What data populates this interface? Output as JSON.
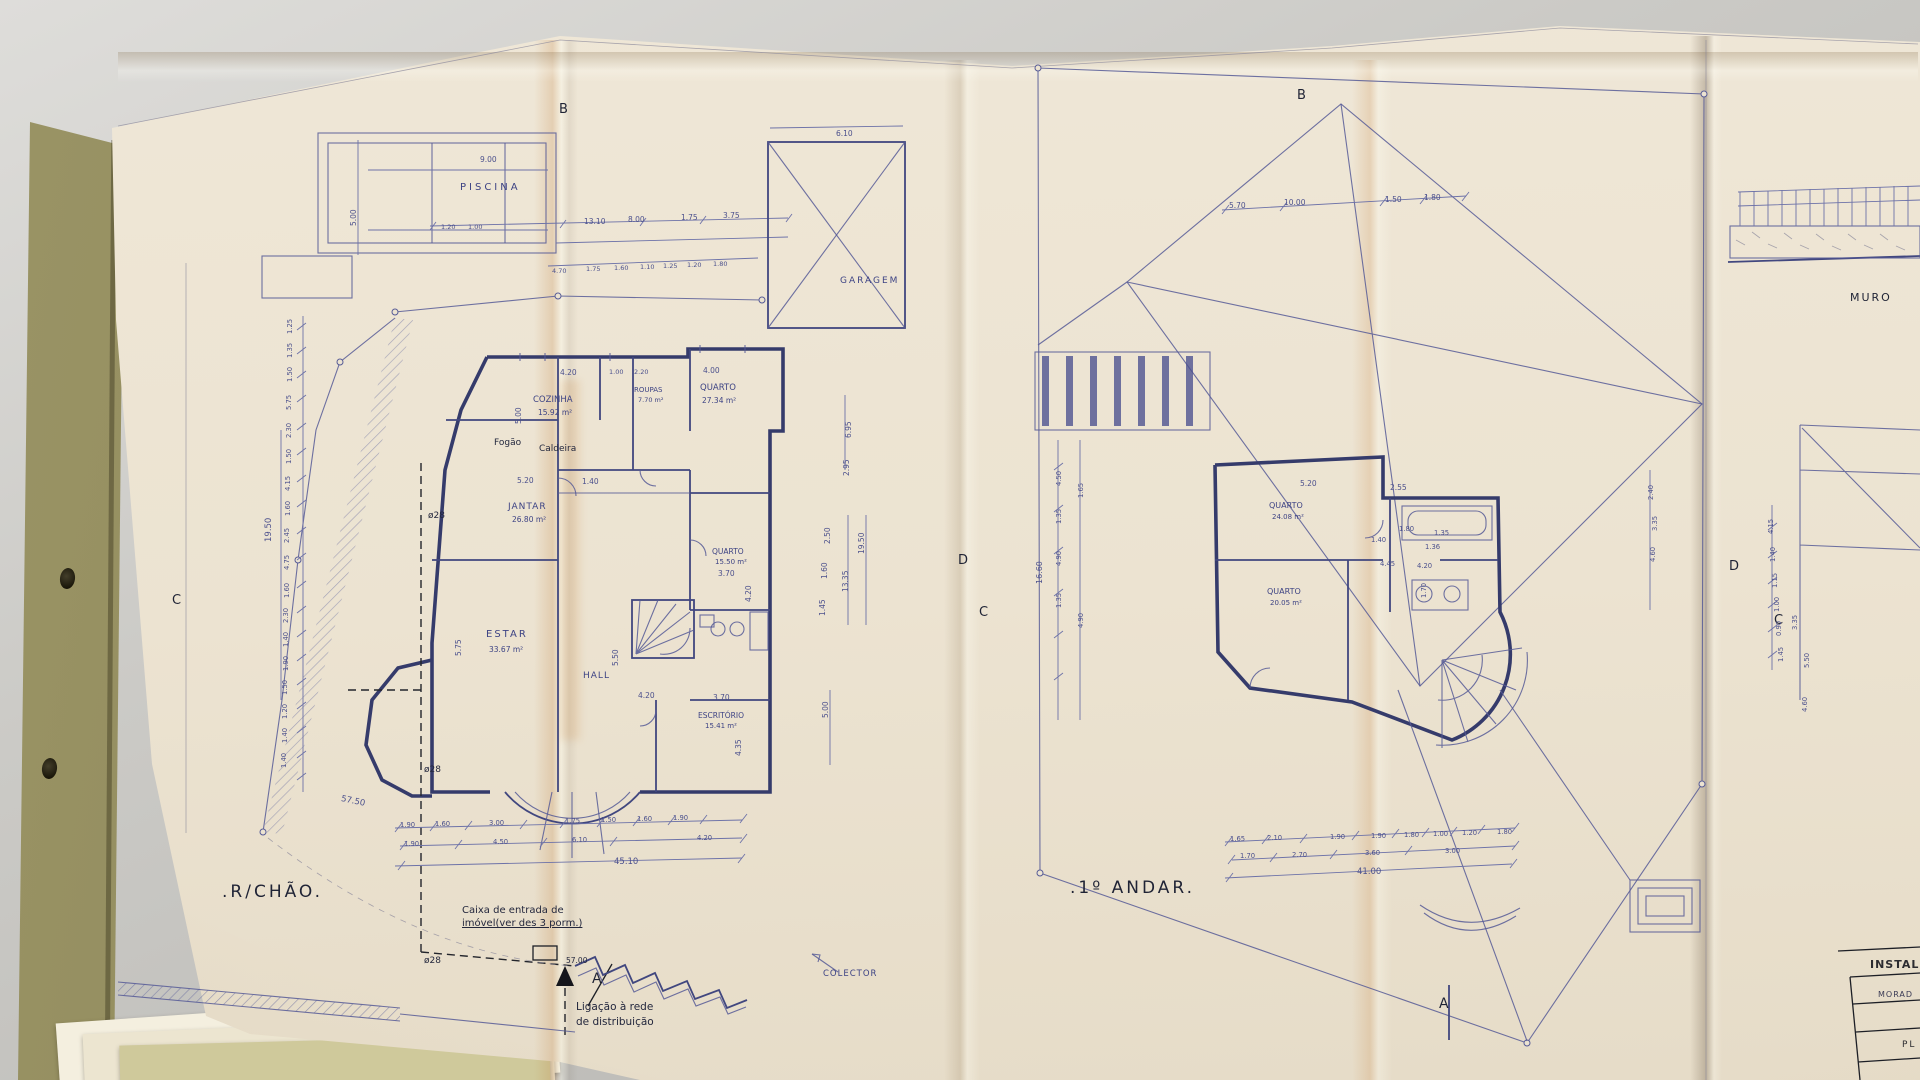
{
  "title_block": {
    "header": "INSTAL",
    "row1": "MORAD",
    "row2": "PL"
  },
  "plans": {
    "ground_floor_label": ".R/CHÃO.",
    "first_floor_label": ".1º ANDAR."
  },
  "colors": {
    "ink": "#3d4384",
    "wall": "#353b6b",
    "paper": "#ece3d1",
    "desk": "#c9c8c4",
    "note_ink": "#23273d",
    "stain": "#c67a34"
  },
  "annotations": [
    {
      "n": "room-label-piscina",
      "t": "PISCINA",
      "x": 460,
      "y": 183,
      "s": 10,
      "k": "ink",
      "ls": 3
    },
    {
      "t": "9.00",
      "x": 480,
      "y": 156,
      "k": "dim"
    },
    {
      "t": "5.00",
      "x": 350,
      "y": 226,
      "r": -90,
      "k": "dim"
    },
    {
      "t": "1.20",
      "x": 441,
      "y": 224,
      "s": 6.5,
      "k": "dim"
    },
    {
      "t": "1.00",
      "x": 468,
      "y": 224,
      "s": 6.5,
      "k": "dim"
    },
    {
      "t": "13.10",
      "x": 584,
      "y": 218,
      "k": "dim"
    },
    {
      "t": "8.00",
      "x": 628,
      "y": 216,
      "k": "dim"
    },
    {
      "t": "1.75",
      "x": 681,
      "y": 214,
      "k": "dim"
    },
    {
      "t": "3.75",
      "x": 723,
      "y": 212,
      "k": "dim"
    },
    {
      "t": "4.70",
      "x": 552,
      "y": 268,
      "s": 6.5,
      "k": "dim"
    },
    {
      "t": "1.75",
      "x": 586,
      "y": 266,
      "s": 6.5,
      "k": "dim"
    },
    {
      "t": "1.60",
      "x": 614,
      "y": 265,
      "s": 6.5,
      "k": "dim"
    },
    {
      "t": "1.10",
      "x": 640,
      "y": 264,
      "s": 6.5,
      "k": "dim"
    },
    {
      "t": "1.25",
      "x": 663,
      "y": 263,
      "s": 6.5,
      "k": "dim"
    },
    {
      "t": "1.20",
      "x": 687,
      "y": 262,
      "s": 6.5,
      "k": "dim"
    },
    {
      "t": "1.80",
      "x": 713,
      "y": 261,
      "s": 6.5,
      "k": "dim"
    },
    {
      "t": "6.10",
      "x": 836,
      "y": 130,
      "k": "dim"
    },
    {
      "n": "room-label-garagem",
      "t": "GARAGEM",
      "x": 840,
      "y": 277,
      "s": 9,
      "k": "ink",
      "ls": 2
    },
    {
      "n": "section-marker-b-left",
      "t": "B",
      "x": 559,
      "y": 103,
      "s": 13,
      "k": "big"
    },
    {
      "n": "room-label-cozinha",
      "t": "COZINHA",
      "x": 533,
      "y": 396,
      "s": 8.5,
      "k": "ink"
    },
    {
      "t": "15.92 m²",
      "x": 538,
      "y": 409,
      "s": 7.5,
      "k": "ink"
    },
    {
      "t": "4.20",
      "x": 560,
      "y": 369,
      "k": "dim"
    },
    {
      "t": "1.00",
      "x": 609,
      "y": 369,
      "s": 6.5,
      "k": "dim"
    },
    {
      "t": "2.20",
      "x": 634,
      "y": 369,
      "s": 6.5,
      "k": "dim"
    },
    {
      "t": "4.00",
      "x": 703,
      "y": 367,
      "k": "dim"
    },
    {
      "n": "room-label-roupas",
      "t": "ROUPAS",
      "x": 634,
      "y": 387,
      "s": 7,
      "k": "ink"
    },
    {
      "t": "7.70 m²",
      "x": 638,
      "y": 397,
      "s": 6.5,
      "k": "ink"
    },
    {
      "n": "room-label-quarto-1",
      "t": "QUARTO",
      "x": 700,
      "y": 384,
      "s": 8.5,
      "k": "ink"
    },
    {
      "t": "27.34 m²",
      "x": 702,
      "y": 397,
      "s": 7.5,
      "k": "ink"
    },
    {
      "n": "note-fogao",
      "t": "Fogão",
      "x": 494,
      "y": 439,
      "s": 9,
      "k": "note"
    },
    {
      "n": "note-caldeira",
      "t": "Caldeira",
      "x": 539,
      "y": 445,
      "s": 9,
      "k": "note"
    },
    {
      "t": "5.00",
      "x": 515,
      "y": 424,
      "r": -90,
      "k": "dim"
    },
    {
      "t": "5.20",
      "x": 517,
      "y": 477,
      "k": "dim"
    },
    {
      "t": "1.40",
      "x": 582,
      "y": 478,
      "k": "dim"
    },
    {
      "n": "note-diameter-1",
      "t": "ø28",
      "x": 428,
      "y": 512,
      "s": 9,
      "k": "note"
    },
    {
      "n": "room-label-jantar",
      "t": "JANTAR",
      "x": 508,
      "y": 503,
      "s": 9,
      "k": "ink",
      "ls": 1
    },
    {
      "t": "26.80 m²",
      "x": 512,
      "y": 516,
      "s": 7.5,
      "k": "ink"
    },
    {
      "n": "room-label-estar",
      "t": "ESTAR",
      "x": 486,
      "y": 630,
      "s": 10,
      "k": "ink",
      "ls": 2
    },
    {
      "t": "33.67 m²",
      "x": 489,
      "y": 646,
      "s": 7.5,
      "k": "ink"
    },
    {
      "t": "5.75",
      "x": 455,
      "y": 656,
      "r": -90,
      "k": "dim"
    },
    {
      "n": "room-label-hall",
      "t": "HALL",
      "x": 583,
      "y": 672,
      "s": 9,
      "k": "ink",
      "ls": 1
    },
    {
      "t": "5.50",
      "x": 612,
      "y": 666,
      "r": -90,
      "k": "dim"
    },
    {
      "t": "4.20",
      "x": 638,
      "y": 692,
      "k": "dim"
    },
    {
      "n": "room-label-quarto-2",
      "t": "QUARTO",
      "x": 712,
      "y": 548,
      "s": 7.5,
      "k": "ink"
    },
    {
      "t": "15.50 m²",
      "x": 715,
      "y": 559,
      "s": 7,
      "k": "ink"
    },
    {
      "t": "3.70",
      "x": 718,
      "y": 570,
      "k": "dim"
    },
    {
      "t": "4.20",
      "x": 745,
      "y": 602,
      "r": -90,
      "k": "dim"
    },
    {
      "n": "room-label-escritorio",
      "t": "ESCRITÓRIO",
      "x": 698,
      "y": 712,
      "s": 7.5,
      "k": "ink"
    },
    {
      "t": "15.41 m²",
      "x": 705,
      "y": 723,
      "s": 7,
      "k": "ink"
    },
    {
      "t": "3.70",
      "x": 713,
      "y": 694,
      "k": "dim"
    },
    {
      "t": "4.35",
      "x": 735,
      "y": 756,
      "r": -90,
      "k": "dim"
    },
    {
      "t": "5.00",
      "x": 822,
      "y": 718,
      "r": -90,
      "k": "dim"
    },
    {
      "t": "2.50",
      "x": 824,
      "y": 544,
      "r": -90,
      "k": "dim"
    },
    {
      "t": "1.60",
      "x": 821,
      "y": 579,
      "r": -90,
      "k": "dim"
    },
    {
      "t": "1.45",
      "x": 819,
      "y": 616,
      "r": -90,
      "k": "dim"
    },
    {
      "t": "13.35",
      "x": 842,
      "y": 592,
      "r": -90,
      "k": "dim"
    },
    {
      "t": "19.50",
      "x": 858,
      "y": 554,
      "r": -90,
      "k": "dim"
    },
    {
      "t": "6.95",
      "x": 845,
      "y": 438,
      "r": -90,
      "k": "dim"
    },
    {
      "t": "2.95",
      "x": 843,
      "y": 476,
      "r": -90,
      "k": "dim"
    },
    {
      "t": "19.50",
      "x": 265,
      "y": 542,
      "r": -90,
      "k": "dim",
      "s": 8.5
    },
    {
      "t": "1.25",
      "x": 287,
      "y": 334,
      "r": -90,
      "k": "dim",
      "s": 6.8
    },
    {
      "t": "1.35",
      "x": 287,
      "y": 358,
      "r": -90,
      "k": "dim",
      "s": 6.8
    },
    {
      "t": "1.50",
      "x": 287,
      "y": 382,
      "r": -90,
      "k": "dim",
      "s": 6.8
    },
    {
      "t": "5.75",
      "x": 286,
      "y": 410,
      "r": -90,
      "k": "dim",
      "s": 6.8
    },
    {
      "t": "2.30",
      "x": 286,
      "y": 438,
      "r": -90,
      "k": "dim",
      "s": 6.8
    },
    {
      "t": "1.50",
      "x": 286,
      "y": 464,
      "r": -90,
      "k": "dim",
      "s": 6.8
    },
    {
      "t": "4.15",
      "x": 285,
      "y": 491,
      "r": -90,
      "k": "dim",
      "s": 6.8
    },
    {
      "t": "1.60",
      "x": 285,
      "y": 516,
      "r": -90,
      "k": "dim",
      "s": 6.8
    },
    {
      "t": "2.45",
      "x": 284,
      "y": 543,
      "r": -90,
      "k": "dim",
      "s": 6.8
    },
    {
      "t": "4.75",
      "x": 284,
      "y": 570,
      "r": -90,
      "k": "dim",
      "s": 6.8
    },
    {
      "t": "1.60",
      "x": 284,
      "y": 598,
      "r": -90,
      "k": "dim",
      "s": 6.8
    },
    {
      "t": "2.30",
      "x": 283,
      "y": 623,
      "r": -90,
      "k": "dim",
      "s": 6.8
    },
    {
      "t": "1.40",
      "x": 283,
      "y": 647,
      "r": -90,
      "k": "dim",
      "s": 6.8
    },
    {
      "t": "1.90",
      "x": 283,
      "y": 671,
      "r": -90,
      "k": "dim",
      "s": 6.8
    },
    {
      "t": "1.50",
      "x": 282,
      "y": 695,
      "r": -90,
      "k": "dim",
      "s": 6.8
    },
    {
      "t": "1.20",
      "x": 282,
      "y": 719,
      "r": -90,
      "k": "dim",
      "s": 6.8
    },
    {
      "t": "1.40",
      "x": 282,
      "y": 743,
      "r": -90,
      "k": "dim",
      "s": 6.8
    },
    {
      "t": "1.40",
      "x": 281,
      "y": 768,
      "r": -90,
      "k": "dim",
      "s": 6.8
    },
    {
      "t": "57.50",
      "x": 342,
      "y": 795,
      "r": 12,
      "k": "dim",
      "s": 8.5
    },
    {
      "t": "1.90",
      "x": 400,
      "y": 822,
      "s": 6.8,
      "k": "dim"
    },
    {
      "t": "1.60",
      "x": 435,
      "y": 821,
      "s": 6.8,
      "k": "dim"
    },
    {
      "t": "3.00",
      "x": 489,
      "y": 820,
      "s": 6.8,
      "k": "dim"
    },
    {
      "t": "1.75",
      "x": 565,
      "y": 818,
      "s": 6.8,
      "k": "dim"
    },
    {
      "t": "1.50",
      "x": 601,
      "y": 817,
      "s": 6.8,
      "k": "dim"
    },
    {
      "t": "1.60",
      "x": 637,
      "y": 816,
      "s": 6.8,
      "k": "dim"
    },
    {
      "t": "1.90",
      "x": 673,
      "y": 815,
      "s": 6.8,
      "k": "dim"
    },
    {
      "t": "1.90",
      "x": 404,
      "y": 841,
      "s": 6.8,
      "k": "dim"
    },
    {
      "t": "4.50",
      "x": 493,
      "y": 839,
      "s": 6.8,
      "k": "dim"
    },
    {
      "t": "6.10",
      "x": 572,
      "y": 837,
      "s": 6.8,
      "k": "dim"
    },
    {
      "t": "4.20",
      "x": 697,
      "y": 835,
      "s": 6.8,
      "k": "dim"
    },
    {
      "t": "45.10",
      "x": 614,
      "y": 858,
      "s": 8.5,
      "k": "dim"
    },
    {
      "n": "note-diameter-2",
      "t": "ø28",
      "x": 424,
      "y": 766,
      "s": 9,
      "k": "note"
    },
    {
      "n": "note-diameter-3",
      "t": "ø28",
      "x": 424,
      "y": 957,
      "s": 9,
      "k": "note"
    },
    {
      "n": "floor-label-ground",
      "t": ".R/CHÃO.",
      "x": 222,
      "y": 884,
      "s": 17,
      "k": "big"
    },
    {
      "n": "note-caixa-line1",
      "t": "Caixa de entrada de",
      "x": 462,
      "y": 906,
      "s": 10,
      "k": "note"
    },
    {
      "n": "note-caixa-line2",
      "t": "imóvel(ver des 3 porm.)",
      "x": 462,
      "y": 919,
      "s": 10,
      "k": "note",
      "u": 1
    },
    {
      "t": "57.00",
      "x": 566,
      "y": 957,
      "s": 7.5,
      "k": "note"
    },
    {
      "n": "section-marker-a-left",
      "t": "A",
      "x": 592,
      "y": 972,
      "s": 14,
      "k": "big"
    },
    {
      "n": "note-ligacao-line1",
      "t": "Ligação à rede",
      "x": 576,
      "y": 1002,
      "s": 10.5,
      "k": "note"
    },
    {
      "n": "note-ligacao-line2",
      "t": "de distribuição",
      "x": 576,
      "y": 1017,
      "s": 10.5,
      "k": "note"
    },
    {
      "n": "label-colector",
      "t": "COLECTOR",
      "x": 823,
      "y": 970,
      "s": 8.5,
      "k": "ink",
      "ls": 1
    },
    {
      "n": "section-marker-c-left",
      "t": "C",
      "x": 172,
      "y": 594,
      "s": 13,
      "k": "big"
    },
    {
      "n": "section-marker-d-left",
      "t": "D",
      "x": 958,
      "y": 554,
      "s": 13,
      "k": "big"
    },
    {
      "n": "section-marker-b-right",
      "t": "B",
      "x": 1297,
      "y": 89,
      "s": 13,
      "k": "big"
    },
    {
      "t": "5.70",
      "x": 1229,
      "y": 202,
      "k": "dim"
    },
    {
      "t": "10.00",
      "x": 1284,
      "y": 199,
      "k": "dim"
    },
    {
      "t": "1.50",
      "x": 1385,
      "y": 196,
      "k": "dim"
    },
    {
      "t": "1.80",
      "x": 1424,
      "y": 194,
      "k": "dim"
    },
    {
      "t": "4.50",
      "x": 1056,
      "y": 486,
      "r": -90,
      "k": "dim",
      "s": 6.8
    },
    {
      "t": "1.35",
      "x": 1056,
      "y": 524,
      "r": -90,
      "k": "dim",
      "s": 6.8
    },
    {
      "t": "4.90",
      "x": 1056,
      "y": 566,
      "r": -90,
      "k": "dim",
      "s": 6.8
    },
    {
      "t": "1.35",
      "x": 1056,
      "y": 608,
      "r": -90,
      "k": "dim",
      "s": 6.8
    },
    {
      "t": "1.65",
      "x": 1078,
      "y": 498,
      "r": -90,
      "k": "dim",
      "s": 6.8
    },
    {
      "t": "4.90",
      "x": 1078,
      "y": 628,
      "r": -90,
      "k": "dim",
      "s": 6.8
    },
    {
      "t": "16.60",
      "x": 1036,
      "y": 584,
      "r": -90,
      "k": "dim",
      "s": 8
    },
    {
      "t": "5.20",
      "x": 1300,
      "y": 480,
      "k": "dim"
    },
    {
      "t": "2.55",
      "x": 1390,
      "y": 484,
      "k": "dim"
    },
    {
      "n": "room-label-quarto-3",
      "t": "QUARTO",
      "x": 1269,
      "y": 502,
      "s": 8,
      "k": "ink"
    },
    {
      "t": "24.08 m²",
      "x": 1272,
      "y": 514,
      "s": 7,
      "k": "ink"
    },
    {
      "t": "1.80",
      "x": 1399,
      "y": 526,
      "s": 6.8,
      "k": "dim"
    },
    {
      "t": "1.35",
      "x": 1434,
      "y": 530,
      "s": 6.8,
      "k": "dim"
    },
    {
      "t": "1.40",
      "x": 1371,
      "y": 537,
      "s": 6.8,
      "k": "dim"
    },
    {
      "t": "1.36",
      "x": 1425,
      "y": 544,
      "s": 6.8,
      "k": "dim"
    },
    {
      "n": "room-label-quarto-4",
      "t": "QUARTO",
      "x": 1267,
      "y": 588,
      "s": 8,
      "k": "ink"
    },
    {
      "t": "20.05 m²",
      "x": 1270,
      "y": 600,
      "s": 7,
      "k": "ink"
    },
    {
      "t": "4.45",
      "x": 1380,
      "y": 561,
      "s": 6.8,
      "k": "dim"
    },
    {
      "t": "4.20",
      "x": 1417,
      "y": 563,
      "s": 6.8,
      "k": "dim"
    },
    {
      "t": "1.70",
      "x": 1421,
      "y": 598,
      "r": -90,
      "s": 6.8,
      "k": "dim"
    },
    {
      "t": "2.40",
      "x": 1648,
      "y": 500,
      "r": -90,
      "k": "dim",
      "s": 6.8
    },
    {
      "t": "3.35",
      "x": 1652,
      "y": 531,
      "r": -90,
      "k": "dim",
      "s": 6.8
    },
    {
      "t": "4.60",
      "x": 1650,
      "y": 562,
      "r": -90,
      "k": "dim",
      "s": 6.8
    },
    {
      "t": "1.65",
      "x": 1230,
      "y": 836,
      "s": 6.8,
      "k": "dim"
    },
    {
      "t": "2.10",
      "x": 1267,
      "y": 835,
      "s": 6.8,
      "k": "dim"
    },
    {
      "t": "1.90",
      "x": 1330,
      "y": 834,
      "s": 6.8,
      "k": "dim"
    },
    {
      "t": "1.90",
      "x": 1371,
      "y": 833,
      "s": 6.8,
      "k": "dim"
    },
    {
      "t": "1.80",
      "x": 1404,
      "y": 832,
      "s": 6.8,
      "k": "dim"
    },
    {
      "t": "1.00",
      "x": 1433,
      "y": 831,
      "s": 6.8,
      "k": "dim"
    },
    {
      "t": "1.20",
      "x": 1462,
      "y": 830,
      "s": 6.8,
      "k": "dim"
    },
    {
      "t": "1.80",
      "x": 1497,
      "y": 829,
      "s": 6.8,
      "k": "dim"
    },
    {
      "t": "1.70",
      "x": 1240,
      "y": 853,
      "s": 6.8,
      "k": "dim"
    },
    {
      "t": "2.70",
      "x": 1292,
      "y": 852,
      "s": 6.8,
      "k": "dim"
    },
    {
      "t": "3.60",
      "x": 1365,
      "y": 850,
      "s": 6.8,
      "k": "dim"
    },
    {
      "t": "3.00",
      "x": 1445,
      "y": 848,
      "s": 6.8,
      "k": "dim"
    },
    {
      "t": "41.00",
      "x": 1357,
      "y": 868,
      "s": 8.5,
      "k": "dim"
    },
    {
      "n": "floor-label-first",
      "t": ".1º ANDAR.",
      "x": 1070,
      "y": 880,
      "s": 17,
      "k": "big"
    },
    {
      "n": "section-marker-c-right",
      "t": "C",
      "x": 979,
      "y": 606,
      "s": 13,
      "k": "big"
    },
    {
      "n": "section-marker-d-right",
      "t": "D",
      "x": 1729,
      "y": 560,
      "s": 13,
      "k": "big"
    },
    {
      "n": "section-marker-a-right",
      "t": "A",
      "x": 1439,
      "y": 997,
      "s": 14,
      "k": "big"
    },
    {
      "n": "section-marker-c-far",
      "t": "C",
      "x": 1774,
      "y": 614,
      "s": 13,
      "k": "big"
    },
    {
      "n": "label-muro",
      "t": "MURO",
      "x": 1850,
      "y": 292,
      "s": 11,
      "k": "big",
      "ls": 2
    },
    {
      "t": "4.15",
      "x": 1768,
      "y": 534,
      "r": -90,
      "k": "dim",
      "s": 6.8
    },
    {
      "t": "1.40",
      "x": 1770,
      "y": 562,
      "r": -90,
      "k": "dim",
      "s": 6.8
    },
    {
      "t": "1.15",
      "x": 1772,
      "y": 588,
      "r": -90,
      "k": "dim",
      "s": 6.8
    },
    {
      "t": "1.00",
      "x": 1774,
      "y": 612,
      "r": -90,
      "k": "dim",
      "s": 6.8
    },
    {
      "t": "0.90",
      "x": 1776,
      "y": 636,
      "r": -90,
      "k": "dim",
      "s": 6.8
    },
    {
      "t": "1.45",
      "x": 1778,
      "y": 662,
      "r": -90,
      "k": "dim",
      "s": 6.8
    },
    {
      "t": "3.35",
      "x": 1792,
      "y": 630,
      "r": -90,
      "k": "dim",
      "s": 6.8
    },
    {
      "t": "5.50",
      "x": 1804,
      "y": 668,
      "r": -90,
      "k": "dim",
      "s": 6.8
    },
    {
      "t": "4.60",
      "x": 1802,
      "y": 712,
      "r": -90,
      "k": "dim",
      "s": 6.8
    }
  ]
}
